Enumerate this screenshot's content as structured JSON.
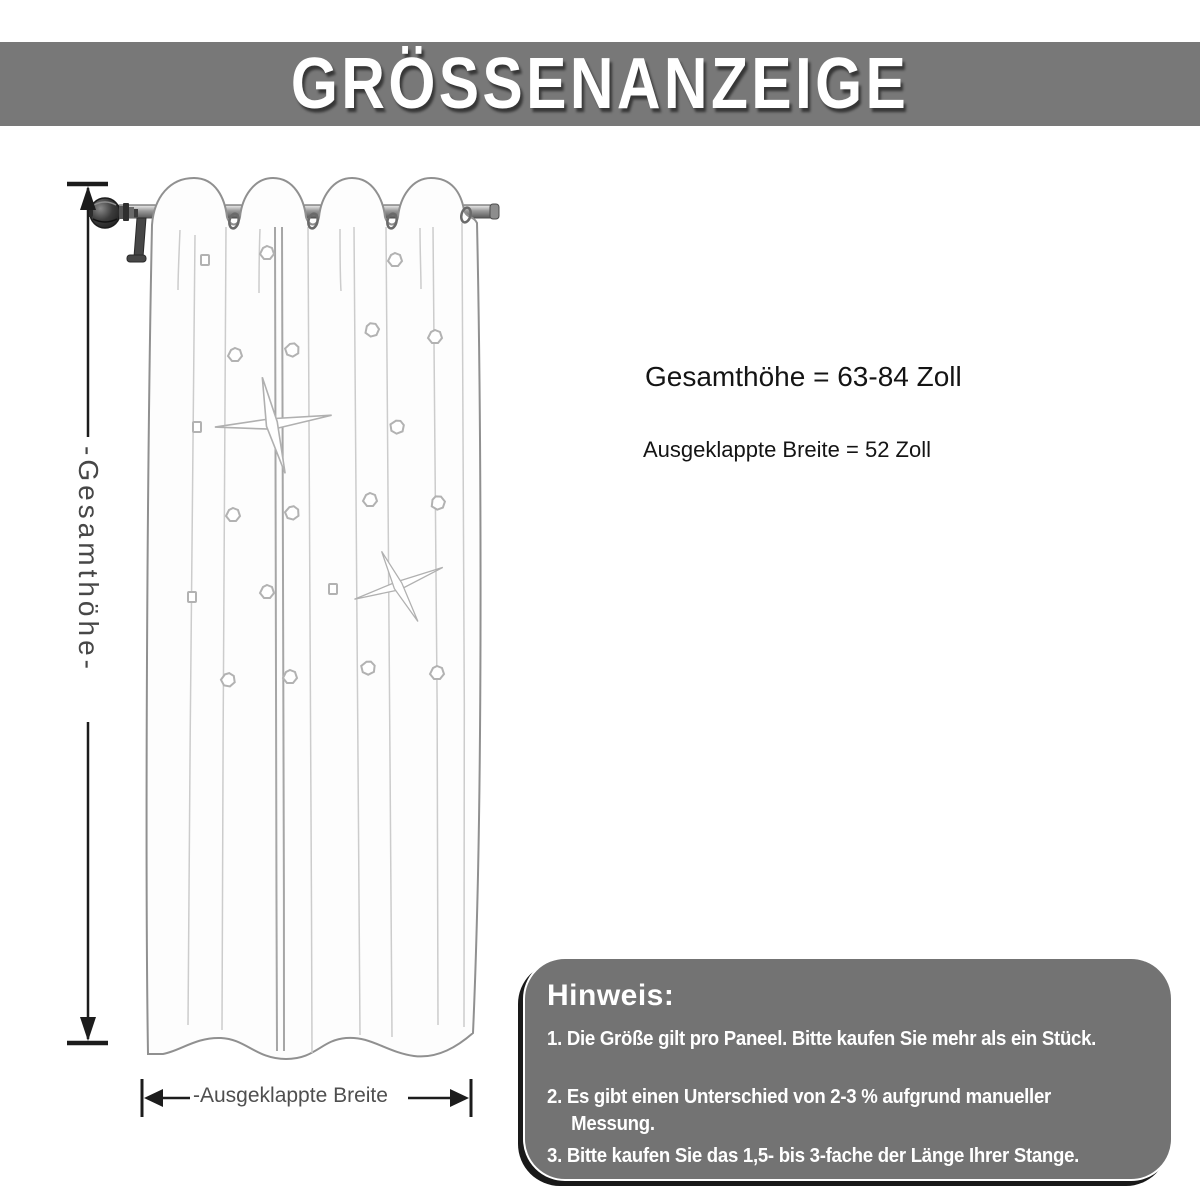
{
  "header": {
    "title": "GRÖSSENANZEIGE"
  },
  "dimensions": {
    "height_text": "Gesamthöhe = 63-84 Zoll",
    "width_text": "Ausgeklappte Breite = 52 Zoll"
  },
  "diagram": {
    "vertical_label": "-Gesamthöhe-",
    "horizontal_label": "-Ausgeklappte Breite"
  },
  "notes": {
    "title": "Hinweis:",
    "items": [
      {
        "lines": [
          "1. Die Größe gilt pro Paneel. Bitte kaufen Sie mehr als ein Stück."
        ]
      },
      {
        "lines": [
          "2. Es gibt einen Unterschied von 2-3 % aufgrund manueller",
          "Messung."
        ]
      },
      {
        "lines": [
          "3. Bitte kaufen Sie das 1,5- bis 3-fache der Länge Ihrer Stange."
        ]
      }
    ]
  },
  "colors": {
    "banner_bg": "#787878",
    "notes_bg": "#737373",
    "notes_text": "#ffffff",
    "measure_line": "#1c1c1c",
    "label_gray": "#4a4a4a",
    "sketch_stroke": "#909090"
  }
}
